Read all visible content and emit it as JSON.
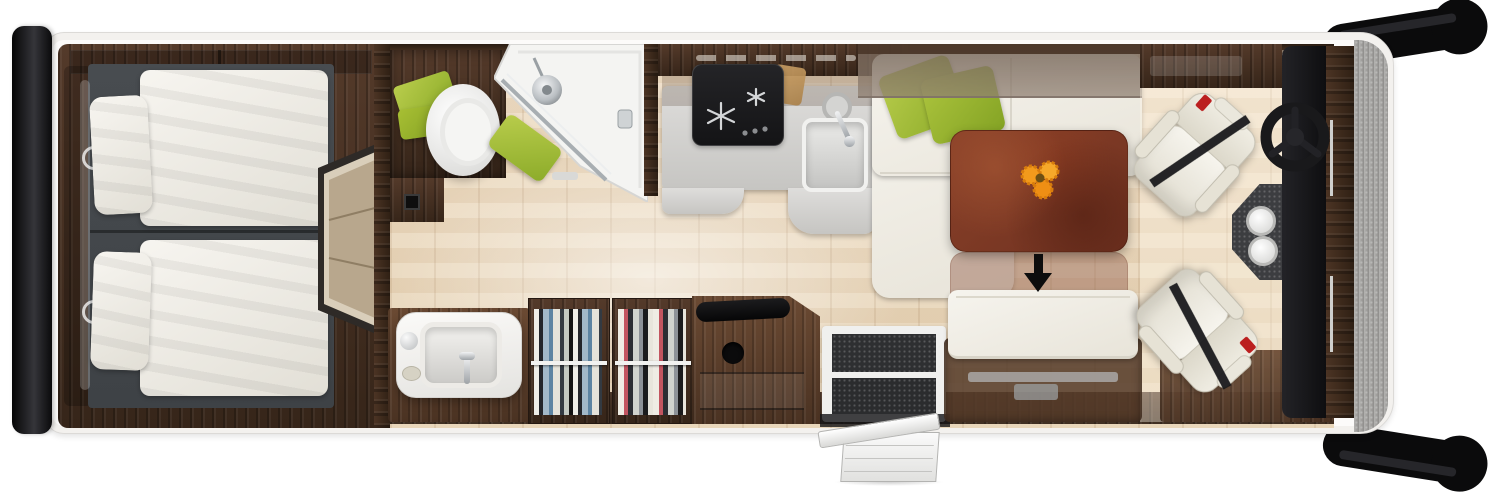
{
  "scene": {
    "title": "Motorhome floor plan – top-down 3D view",
    "render_type": "photorealistic floorplan, no visible text",
    "vehicle": {
      "rear_bumper": "black bumper bar at rear (left edge)",
      "front_wheels": [
        "front-wheel-top-right",
        "front-wheel-bottom-right"
      ],
      "entry_steps": "fold-out entry steps outside the habitation door",
      "front_end": "grey cab front at right"
    },
    "zones": {
      "bedroom": {
        "label": "Rear bedroom with two single beds, white duvets and pillows on charcoal bases"
      },
      "bathroom": {
        "label": "Bathroom with white toilet, corner shower with chrome fittings, green towels"
      },
      "kitchen": {
        "label": "Kitchen with black gas hob, grey worktop, sink with tap and chopping board"
      },
      "wardrobe": {
        "label": "Washbasin vanity, two hanging wardrobes with clothes, TV sideboard"
      },
      "lounge": {
        "label": "Lounge with white L-shaped sofa, green cushions, red-brown table with flowers, bench seat"
      },
      "cab": {
        "label": "Driver cab with two swivelled white captain seats, black steering wheel and dark console with two cup holders"
      }
    },
    "indicator": {
      "table_arrow": "black arrow showing the table sliding toward the bench"
    },
    "accents": {
      "towels_cushions": "green",
      "flowers": "orange",
      "seatbelt_buckle": "red"
    },
    "palette": {
      "background": "#ffffff",
      "body_outline": "#e4e2df",
      "dark_wood": "#45301f",
      "mid_wood": "#6b4a33",
      "floor_wood": "#ecdcc3",
      "bed_base_grey": "#45494d",
      "linen_white": "#f1efe9",
      "accent_green": "#a4bf3a",
      "table_brown": "#7e3a27",
      "flower_orange": "#f29a1c",
      "counter_grey": "#d7d6d3",
      "appliance_black": "#1e1e20",
      "cab_front_grey": "#a3a2a0",
      "tyre_black": "#0b0b0c"
    }
  }
}
